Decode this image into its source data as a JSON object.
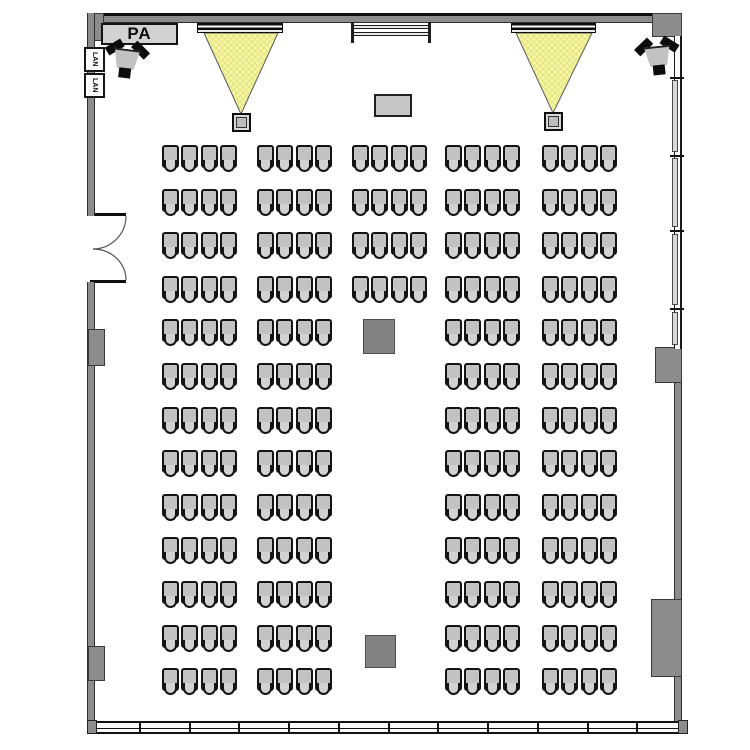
{
  "labels": {
    "pa": "PA",
    "lan": "LAN"
  },
  "colors": {
    "wall": "#8c8c8c",
    "outline": "#141414",
    "seat": "#c2c2c2",
    "seatback": "#d2d2d2",
    "beam": "#f6f6a8",
    "beam_hatch": "#e4e47e",
    "pillar": "#828282",
    "pane": "#d9d9d9"
  },
  "seating": {
    "rows_start_y": 145,
    "row_spacing": 43.6,
    "seats_per_group": 4,
    "group_width": 75,
    "columns": [
      {
        "id": "far-left",
        "x": 162,
        "row_count": 13
      },
      {
        "id": "mid-left",
        "x": 257,
        "row_count": 13
      },
      {
        "id": "center",
        "x": 352,
        "row_count": 4
      },
      {
        "id": "mid-right",
        "x": 445,
        "row_count": 13
      },
      {
        "id": "far-right",
        "x": 542,
        "row_count": 13
      }
    ],
    "total_seats": 224
  },
  "bottom_window": {
    "panes": 12
  },
  "right_window": {
    "tick_ys": [
      77,
      155,
      230,
      308
    ],
    "pane_segments": [
      [
        80,
        152
      ],
      [
        158,
        227
      ],
      [
        234,
        305
      ],
      [
        312,
        345
      ]
    ]
  }
}
